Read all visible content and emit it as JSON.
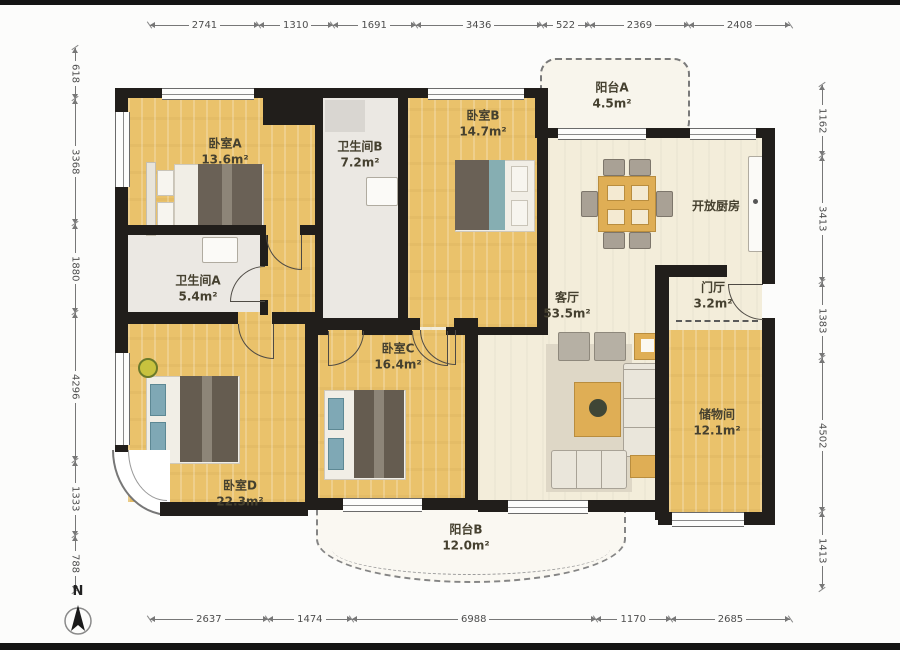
{
  "meta": {
    "north_label": "N",
    "type": "apartment-floor-plan"
  },
  "colors": {
    "wall": "#211e1b",
    "wood_floor": "#eac26b",
    "living_floor": "#f3edda",
    "bath_floor": "#ebe8e3",
    "balcony_fill": "#f8f5ec",
    "dimension_text": "#4e4e4e"
  },
  "dims": {
    "top": [
      "2741",
      "1310",
      "1691",
      "3436",
      "522",
      "2369",
      "2408"
    ],
    "bottom": [
      "2637",
      "1474",
      "6988",
      "1170",
      "2685"
    ],
    "left": [
      "618",
      "3368",
      "1880",
      "4296",
      "1333",
      "788"
    ],
    "right": [
      "1162",
      "3413",
      "1383",
      "4502",
      "1413"
    ]
  },
  "rooms": {
    "bedroomA": {
      "name": "卧室A",
      "area": "13.6m²"
    },
    "bathroomB": {
      "name": "卫生间B",
      "area": "7.2m²"
    },
    "bedroomB": {
      "name": "卧室B",
      "area": "14.7m²"
    },
    "balconyA": {
      "name": "阳台A",
      "area": "4.5m²"
    },
    "kitchen": {
      "name": "开放厨房",
      "area": ""
    },
    "bathroomA": {
      "name": "卫生间A",
      "area": "5.4m²"
    },
    "living": {
      "name": "客厅",
      "area": "53.5m²"
    },
    "foyer": {
      "name": "门厅",
      "area": "3.2m²"
    },
    "bedroomC": {
      "name": "卧室C",
      "area": "16.4m²"
    },
    "storage": {
      "name": "储物间",
      "area": "12.1m²"
    },
    "bedroomD": {
      "name": "卧室D",
      "area": "22.3m²"
    },
    "balconyB": {
      "name": "阳台B",
      "area": "12.0m²"
    }
  }
}
